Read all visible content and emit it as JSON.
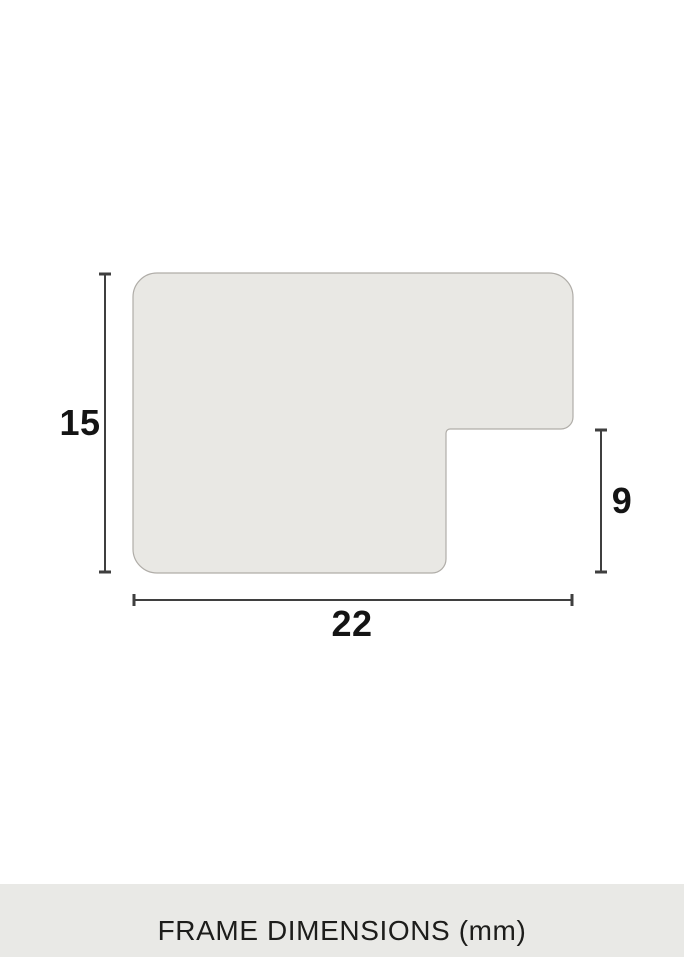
{
  "diagram": {
    "caption": "FRAME DIMENSIONS (mm)",
    "unit": "mm",
    "dimensions": {
      "height": "15",
      "depth": "9",
      "width": "22"
    },
    "colors": {
      "background": "#ffffff",
      "shape_fill": "#e9e8e4",
      "shape_stroke": "#b0ada8",
      "dimension_line": "#3f3f3f",
      "label_text": "#141414",
      "caption_band": "#e9e9e6",
      "caption_text": "#1d1d1b"
    }
  }
}
